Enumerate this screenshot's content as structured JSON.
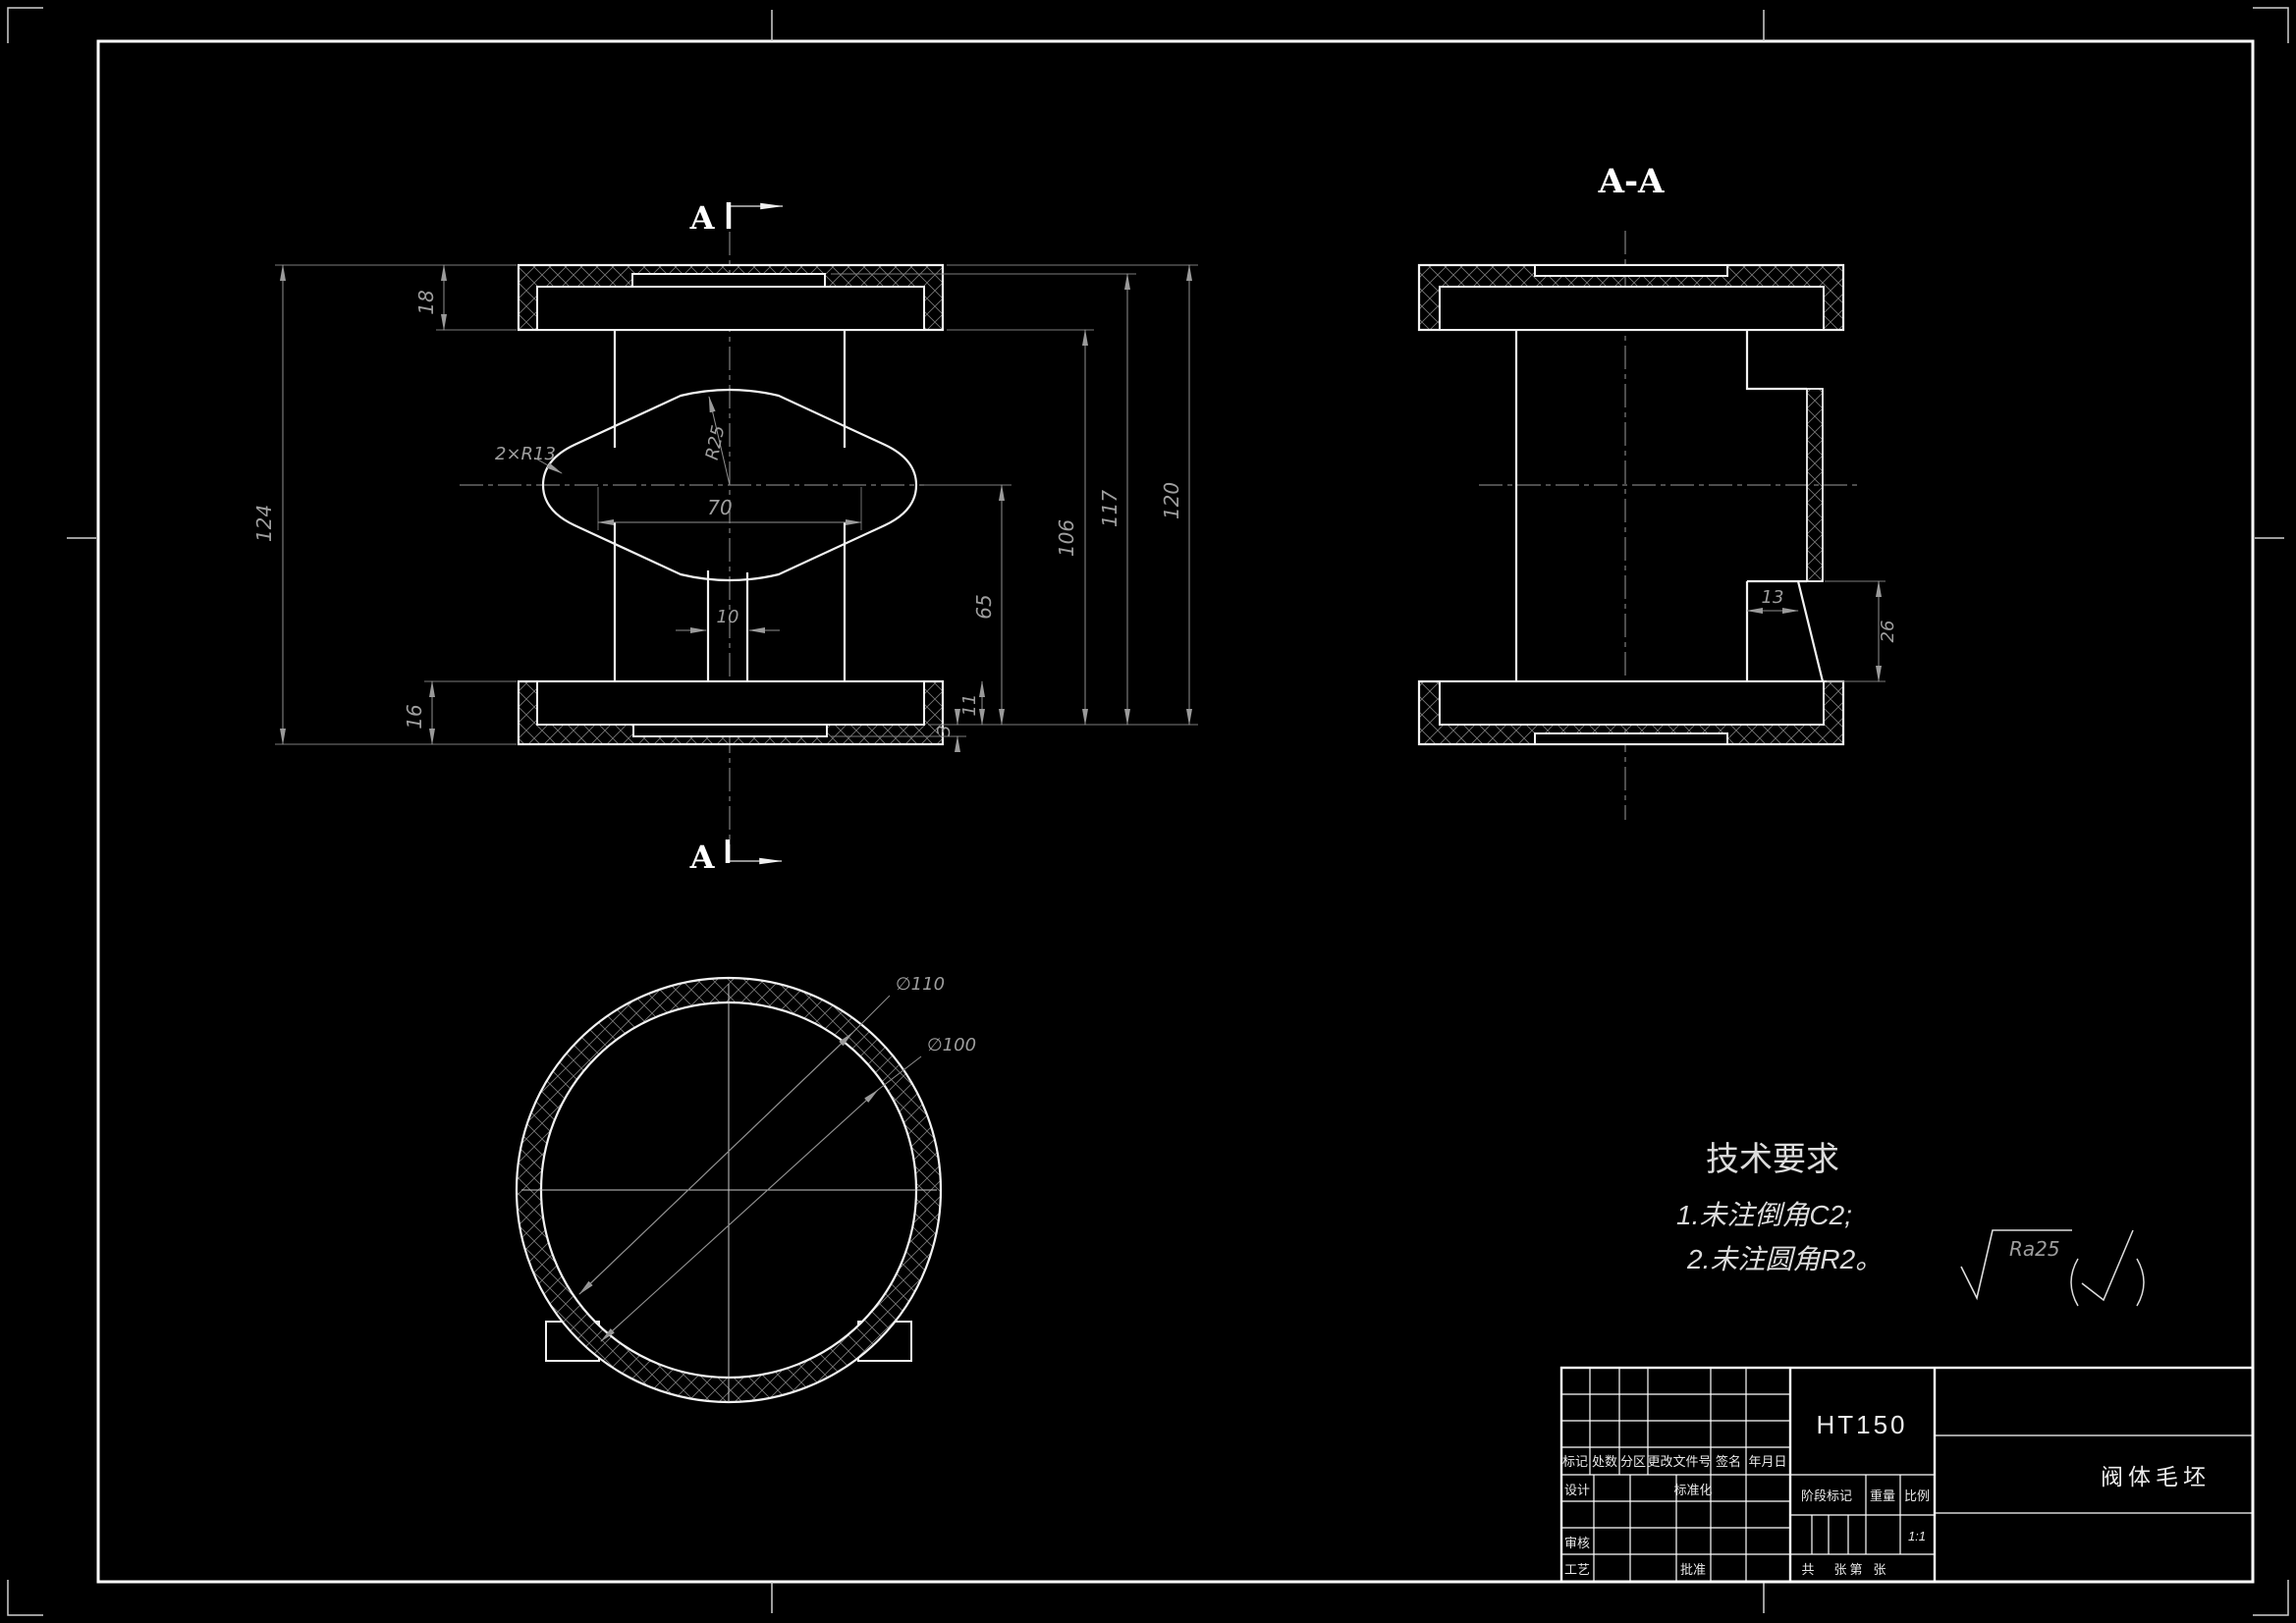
{
  "sheet": {
    "background": "#000000",
    "outline_color": "#f2f2f2",
    "dim_color": "#8f8f8f",
    "frame_color": "#ffffff"
  },
  "front_view": {
    "section_letter_top": "A",
    "section_letter_bottom": "A",
    "dim_overall_height": "124",
    "dim_top_flange": "18",
    "dim_bottom_flange": "16",
    "dim_boss_span": "70",
    "dim_stem_width": "10",
    "dim_h65": "65",
    "dim_h106": "106",
    "dim_h117": "117",
    "dim_h120": "120",
    "dim_recess": "11",
    "dim_step": "3",
    "label_side_radius": "2×R13",
    "label_top_radius": "R25"
  },
  "section_view": {
    "title": "A-A",
    "dim_width": "13",
    "dim_height": "26"
  },
  "bottom_view": {
    "dim_outer_dia": "∅110",
    "dim_inner_dia": "∅100"
  },
  "tech_requirements": {
    "title": "技术要求",
    "item1": "1.未注倒角C2;",
    "item2": "2.未注圆角R2。",
    "roughness": "Ra25"
  },
  "title_block": {
    "material": "HT150",
    "part_name": "阀体毛坯",
    "col_mark": "标记",
    "col_count": "处数",
    "col_zone": "分区",
    "col_change_no": "更改文件号",
    "col_sign": "签名",
    "col_date": "年月日",
    "row_design": "设计",
    "row_standardize": "标准化",
    "row_check": "审核",
    "row_process": "工艺",
    "row_approve": "批准",
    "stage_mark": "阶段标记",
    "weight": "重量",
    "scale_label": "比例",
    "scale_value": "1:1",
    "total_label": "共",
    "total_unit": "张",
    "page_label": "第",
    "page_unit": "张"
  }
}
